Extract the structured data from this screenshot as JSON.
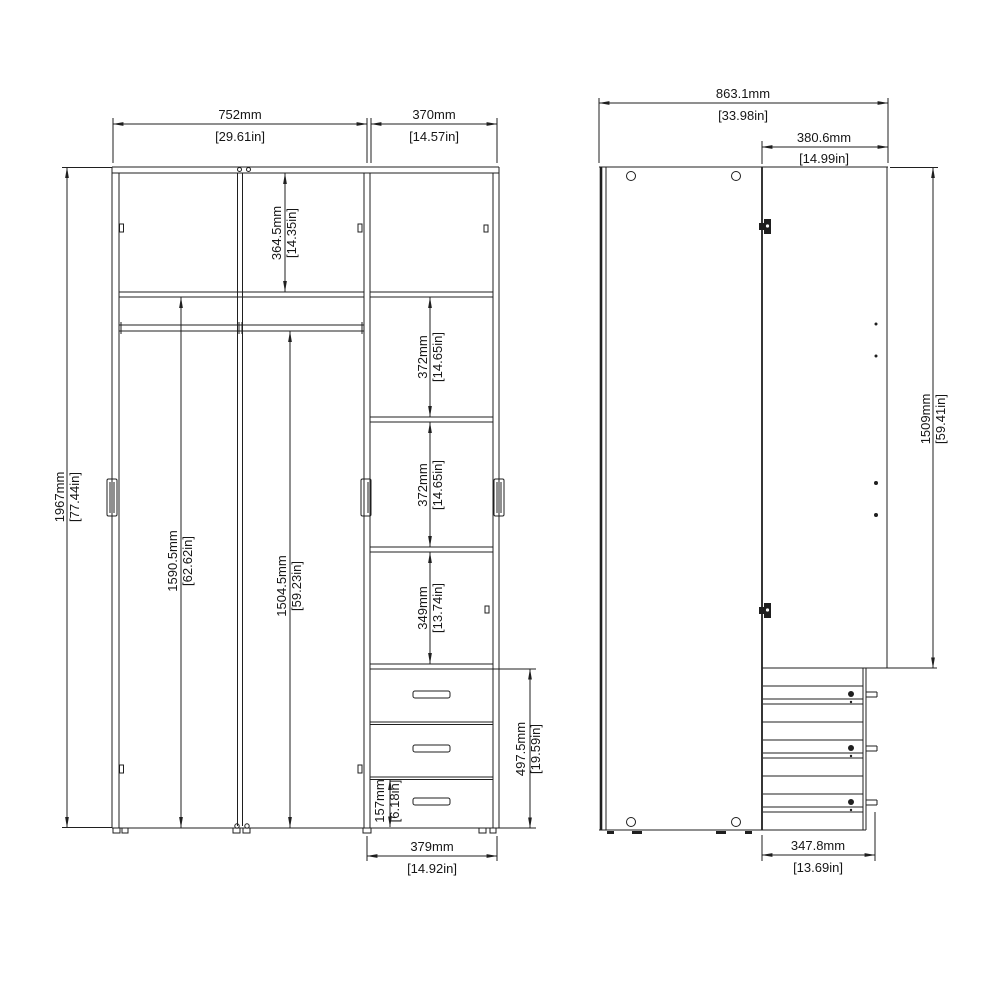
{
  "front": {
    "w_doors_mm": "752mm",
    "w_doors_in": "[29.61in]",
    "w_col_mm": "370mm",
    "w_col_in": "[14.57in]",
    "h_total_mm": "1967mm",
    "h_total_in": "[77.44in]",
    "h_top_mm": "364.5mm",
    "h_top_in": "[14.35in]",
    "h_left_mm": "1590.5mm",
    "h_left_in": "[62.62in]",
    "h_mid_mm": "1504.5mm",
    "h_mid_in": "[59.23in]",
    "s1_mm": "372mm",
    "s1_in": "[14.65in]",
    "s2_mm": "372mm",
    "s2_in": "[14.65in]",
    "s3_mm": "349mm",
    "s3_in": "[13.74in]",
    "h_drawers_mm": "497.5mm",
    "h_drawers_in": "[19.59in]",
    "h_bdrawer_mm": "157mm",
    "h_bdrawer_in": "[6.18in]",
    "w_drawer_mm": "379mm",
    "w_drawer_in": "[14.92in]"
  },
  "side": {
    "d_total_mm": "863.1mm",
    "d_total_in": "[33.98in]",
    "d_cab_mm": "380.6mm",
    "d_cab_in": "[14.99in]",
    "h_upper_mm": "1509mm",
    "h_upper_in": "[59.41in]",
    "d_drawer_mm": "347.8mm",
    "d_drawer_in": "[13.69in]"
  }
}
